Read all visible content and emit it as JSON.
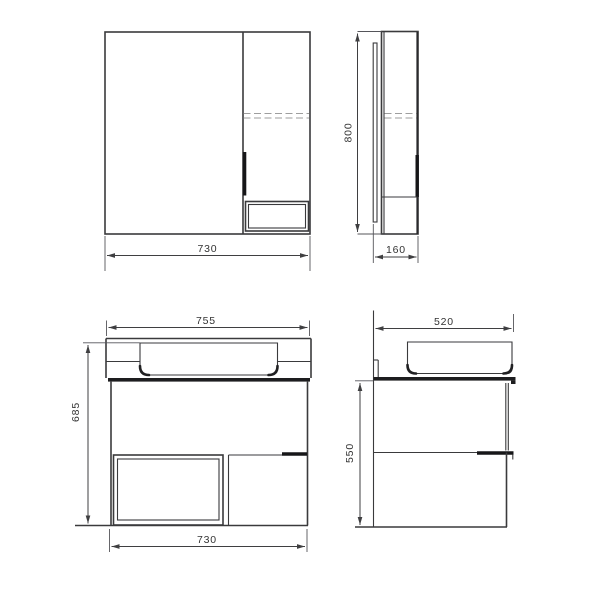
{
  "drawing": {
    "colors": {
      "line": "#3a3a3c",
      "thick_line": "#161618",
      "dashed_line": "#9e9e9e",
      "dimension_text": "#333333",
      "background": "#ffffff"
    },
    "mirror_front": {
      "width": "730"
    },
    "mirror_side": {
      "height": "800",
      "depth": "160"
    },
    "vanity_front": {
      "top_width": "755",
      "height": "685",
      "bottom_width": "730"
    },
    "vanity_side": {
      "depth": "520",
      "height": "550"
    }
  }
}
